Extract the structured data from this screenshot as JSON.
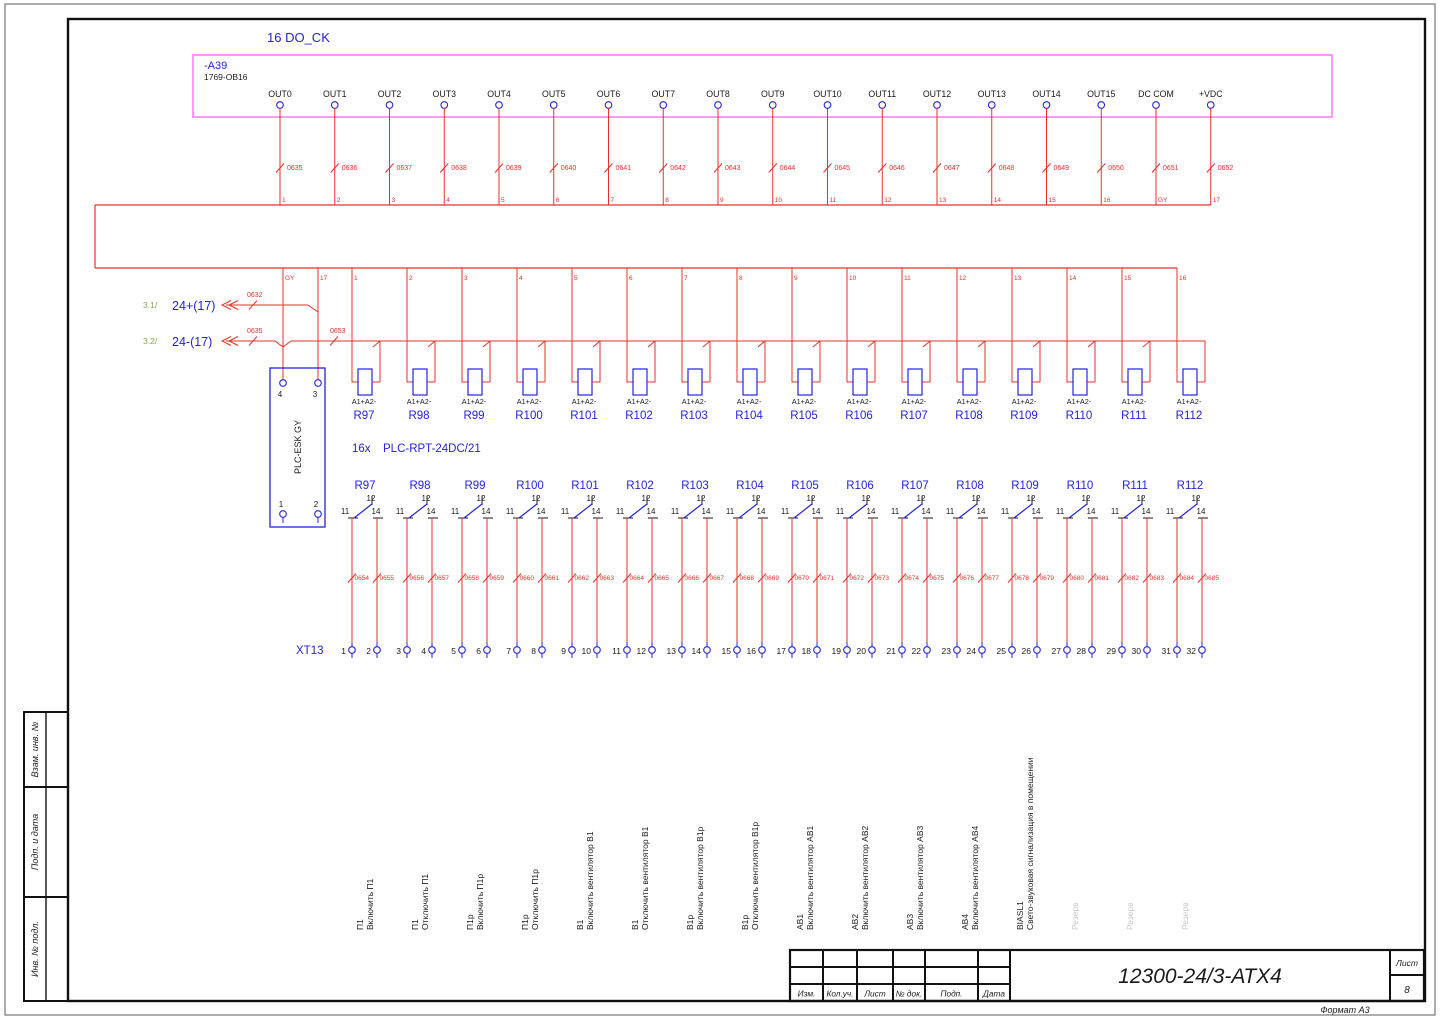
{
  "sheet": {
    "title": "16 DO_CK",
    "module": {
      "ref": "-A39",
      "type": "1769-OB16",
      "pins": [
        "OUT0",
        "OUT1",
        "OUT2",
        "OUT3",
        "OUT4",
        "OUT5",
        "OUT6",
        "OUT7",
        "OUT8",
        "OUT9",
        "OUT10",
        "OUT11",
        "OUT12",
        "OUT13",
        "OUT14",
        "OUT15",
        "DC COM",
        "+VDC"
      ]
    },
    "output_wires": [
      {
        "num": "0635",
        "tap": "1"
      },
      {
        "num": "0636",
        "tap": "2"
      },
      {
        "num": "0637",
        "tap": "3"
      },
      {
        "num": "0638",
        "tap": "4"
      },
      {
        "num": "0639",
        "tap": "5"
      },
      {
        "num": "0640",
        "tap": "6"
      },
      {
        "num": "0641",
        "tap": "7"
      },
      {
        "num": "0642",
        "tap": "8"
      },
      {
        "num": "0643",
        "tap": "9"
      },
      {
        "num": "0644",
        "tap": "10"
      },
      {
        "num": "0645",
        "tap": "11"
      },
      {
        "num": "0646",
        "tap": "12"
      },
      {
        "num": "0647",
        "tap": "13"
      },
      {
        "num": "0648",
        "tap": "14"
      },
      {
        "num": "0649",
        "tap": "15"
      },
      {
        "num": "0650",
        "tap": "16"
      },
      {
        "num": "0651",
        "tap": "GY"
      },
      {
        "num": "0652",
        "tap": "17"
      }
    ],
    "bundle_taps": [
      "GY",
      "17",
      "1",
      "2",
      "3",
      "4",
      "5",
      "6",
      "7",
      "8",
      "9",
      "10",
      "11",
      "12",
      "13",
      "14",
      "15",
      "16"
    ],
    "supply_plus": {
      "sheet_ref": "3.1/",
      "label": "24+(17)",
      "wire": "0632"
    },
    "supply_minus": {
      "sheet_ref": "3.2/",
      "label": "24-(17)",
      "wire_left": "0635",
      "wire_right": "0653"
    },
    "interface_module": {
      "label": "PLC-ESK GY",
      "pin_top_left": "4",
      "pin_top_right": "3",
      "pin_bottom_left": "1",
      "pin_bottom_right": "2"
    },
    "relay_note_qty": "16x",
    "relay_note_type": "PLC-RPT-24DC/21",
    "coil_terminals": "A1+A2-",
    "contact_pins": {
      "p11": "11",
      "p12": "12",
      "p14": "14"
    },
    "terminal_strip": "XT13",
    "relays": [
      {
        "name": "R97",
        "tap": "1",
        "wire11": "0654",
        "wire14": "0655",
        "term11": "1",
        "term14": "2",
        "desc": [
          "П1",
          "Включить П1"
        ],
        "reserve": false
      },
      {
        "name": "R98",
        "tap": "2",
        "wire11": "0656",
        "wire14": "0657",
        "term11": "3",
        "term14": "4",
        "desc": [
          "П1",
          "Отключить П1"
        ],
        "reserve": false
      },
      {
        "name": "R99",
        "tap": "3",
        "wire11": "0658",
        "wire14": "0659",
        "term11": "5",
        "term14": "6",
        "desc": [
          "П1р",
          "Включить П1р"
        ],
        "reserve": false
      },
      {
        "name": "R100",
        "tap": "4",
        "wire11": "0660",
        "wire14": "0661",
        "term11": "7",
        "term14": "8",
        "desc": [
          "П1р",
          "Отключить П1р"
        ],
        "reserve": false
      },
      {
        "name": "R101",
        "tap": "5",
        "wire11": "0662",
        "wire14": "0663",
        "term11": "9",
        "term14": "10",
        "desc": [
          "В1",
          "Включить вентилятор В1"
        ],
        "reserve": false
      },
      {
        "name": "R102",
        "tap": "6",
        "wire11": "0664",
        "wire14": "0665",
        "term11": "11",
        "term14": "12",
        "desc": [
          "В1",
          "Отключить вентилятор В1"
        ],
        "reserve": false
      },
      {
        "name": "R103",
        "tap": "7",
        "wire11": "0666",
        "wire14": "0667",
        "term11": "13",
        "term14": "14",
        "desc": [
          "В1р",
          "Включить вентилятор В1р"
        ],
        "reserve": false
      },
      {
        "name": "R104",
        "tap": "8",
        "wire11": "0668",
        "wire14": "0669",
        "term11": "15",
        "term14": "16",
        "desc": [
          "В1р",
          "Отключить вентилятор В1р"
        ],
        "reserve": false
      },
      {
        "name": "R105",
        "tap": "9",
        "wire11": "0670",
        "wire14": "0671",
        "term11": "17",
        "term14": "18",
        "desc": [
          "АВ1",
          "Включить вентилятор АВ1"
        ],
        "reserve": false
      },
      {
        "name": "R106",
        "tap": "10",
        "wire11": "0672",
        "wire14": "0673",
        "term11": "19",
        "term14": "20",
        "desc": [
          "АВ2",
          "Включить вентилятор АВ2"
        ],
        "reserve": false
      },
      {
        "name": "R107",
        "tap": "11",
        "wire11": "0674",
        "wire14": "0675",
        "term11": "21",
        "term14": "22",
        "desc": [
          "АВ3",
          "Включить вентилятор АВ3"
        ],
        "reserve": false
      },
      {
        "name": "R108",
        "tap": "12",
        "wire11": "0676",
        "wire14": "0677",
        "term11": "23",
        "term14": "24",
        "desc": [
          "АВ4",
          "Включить вентилятор АВ4"
        ],
        "reserve": false
      },
      {
        "name": "R109",
        "tap": "13",
        "wire11": "0678",
        "wire14": "0679",
        "term11": "25",
        "term14": "26",
        "desc": [
          "BIASL1",
          "Свето-звуковая сигнализация в помещении"
        ],
        "reserve": false
      },
      {
        "name": "R110",
        "tap": "14",
        "wire11": "0680",
        "wire14": "0681",
        "term11": "27",
        "term14": "28",
        "desc": [
          "Резерв"
        ],
        "reserve": true
      },
      {
        "name": "R111",
        "tap": "15",
        "wire11": "0682",
        "wire14": "0683",
        "term11": "29",
        "term14": "30",
        "desc": [
          "Резерв"
        ],
        "reserve": true
      },
      {
        "name": "R112",
        "tap": "16",
        "wire11": "0684",
        "wire14": "0685",
        "term11": "31",
        "term14": "32",
        "desc": [
          "Резерв"
        ],
        "reserve": true
      }
    ]
  },
  "frame": {
    "stamp_rows": [
      "Взам. инв. №",
      "Подп. и дата",
      "Инв. № подл."
    ],
    "revision_columns": [
      "Изм.",
      "Кол.уч.",
      "Лист",
      "№ док.",
      "Подп.",
      "Дата"
    ],
    "doc_number": "12300-24/3-АТХ4",
    "sheet_label": "Лист",
    "sheet_number": "8",
    "format_note": "Формат А3"
  },
  "colors": {
    "wire": "#e8302a",
    "device": "#2323dc",
    "module_border": "#ff6bff",
    "reference_green": "#8aa851",
    "reserve_gray": "#c9c9c9",
    "ink": "#1a1a1a"
  }
}
